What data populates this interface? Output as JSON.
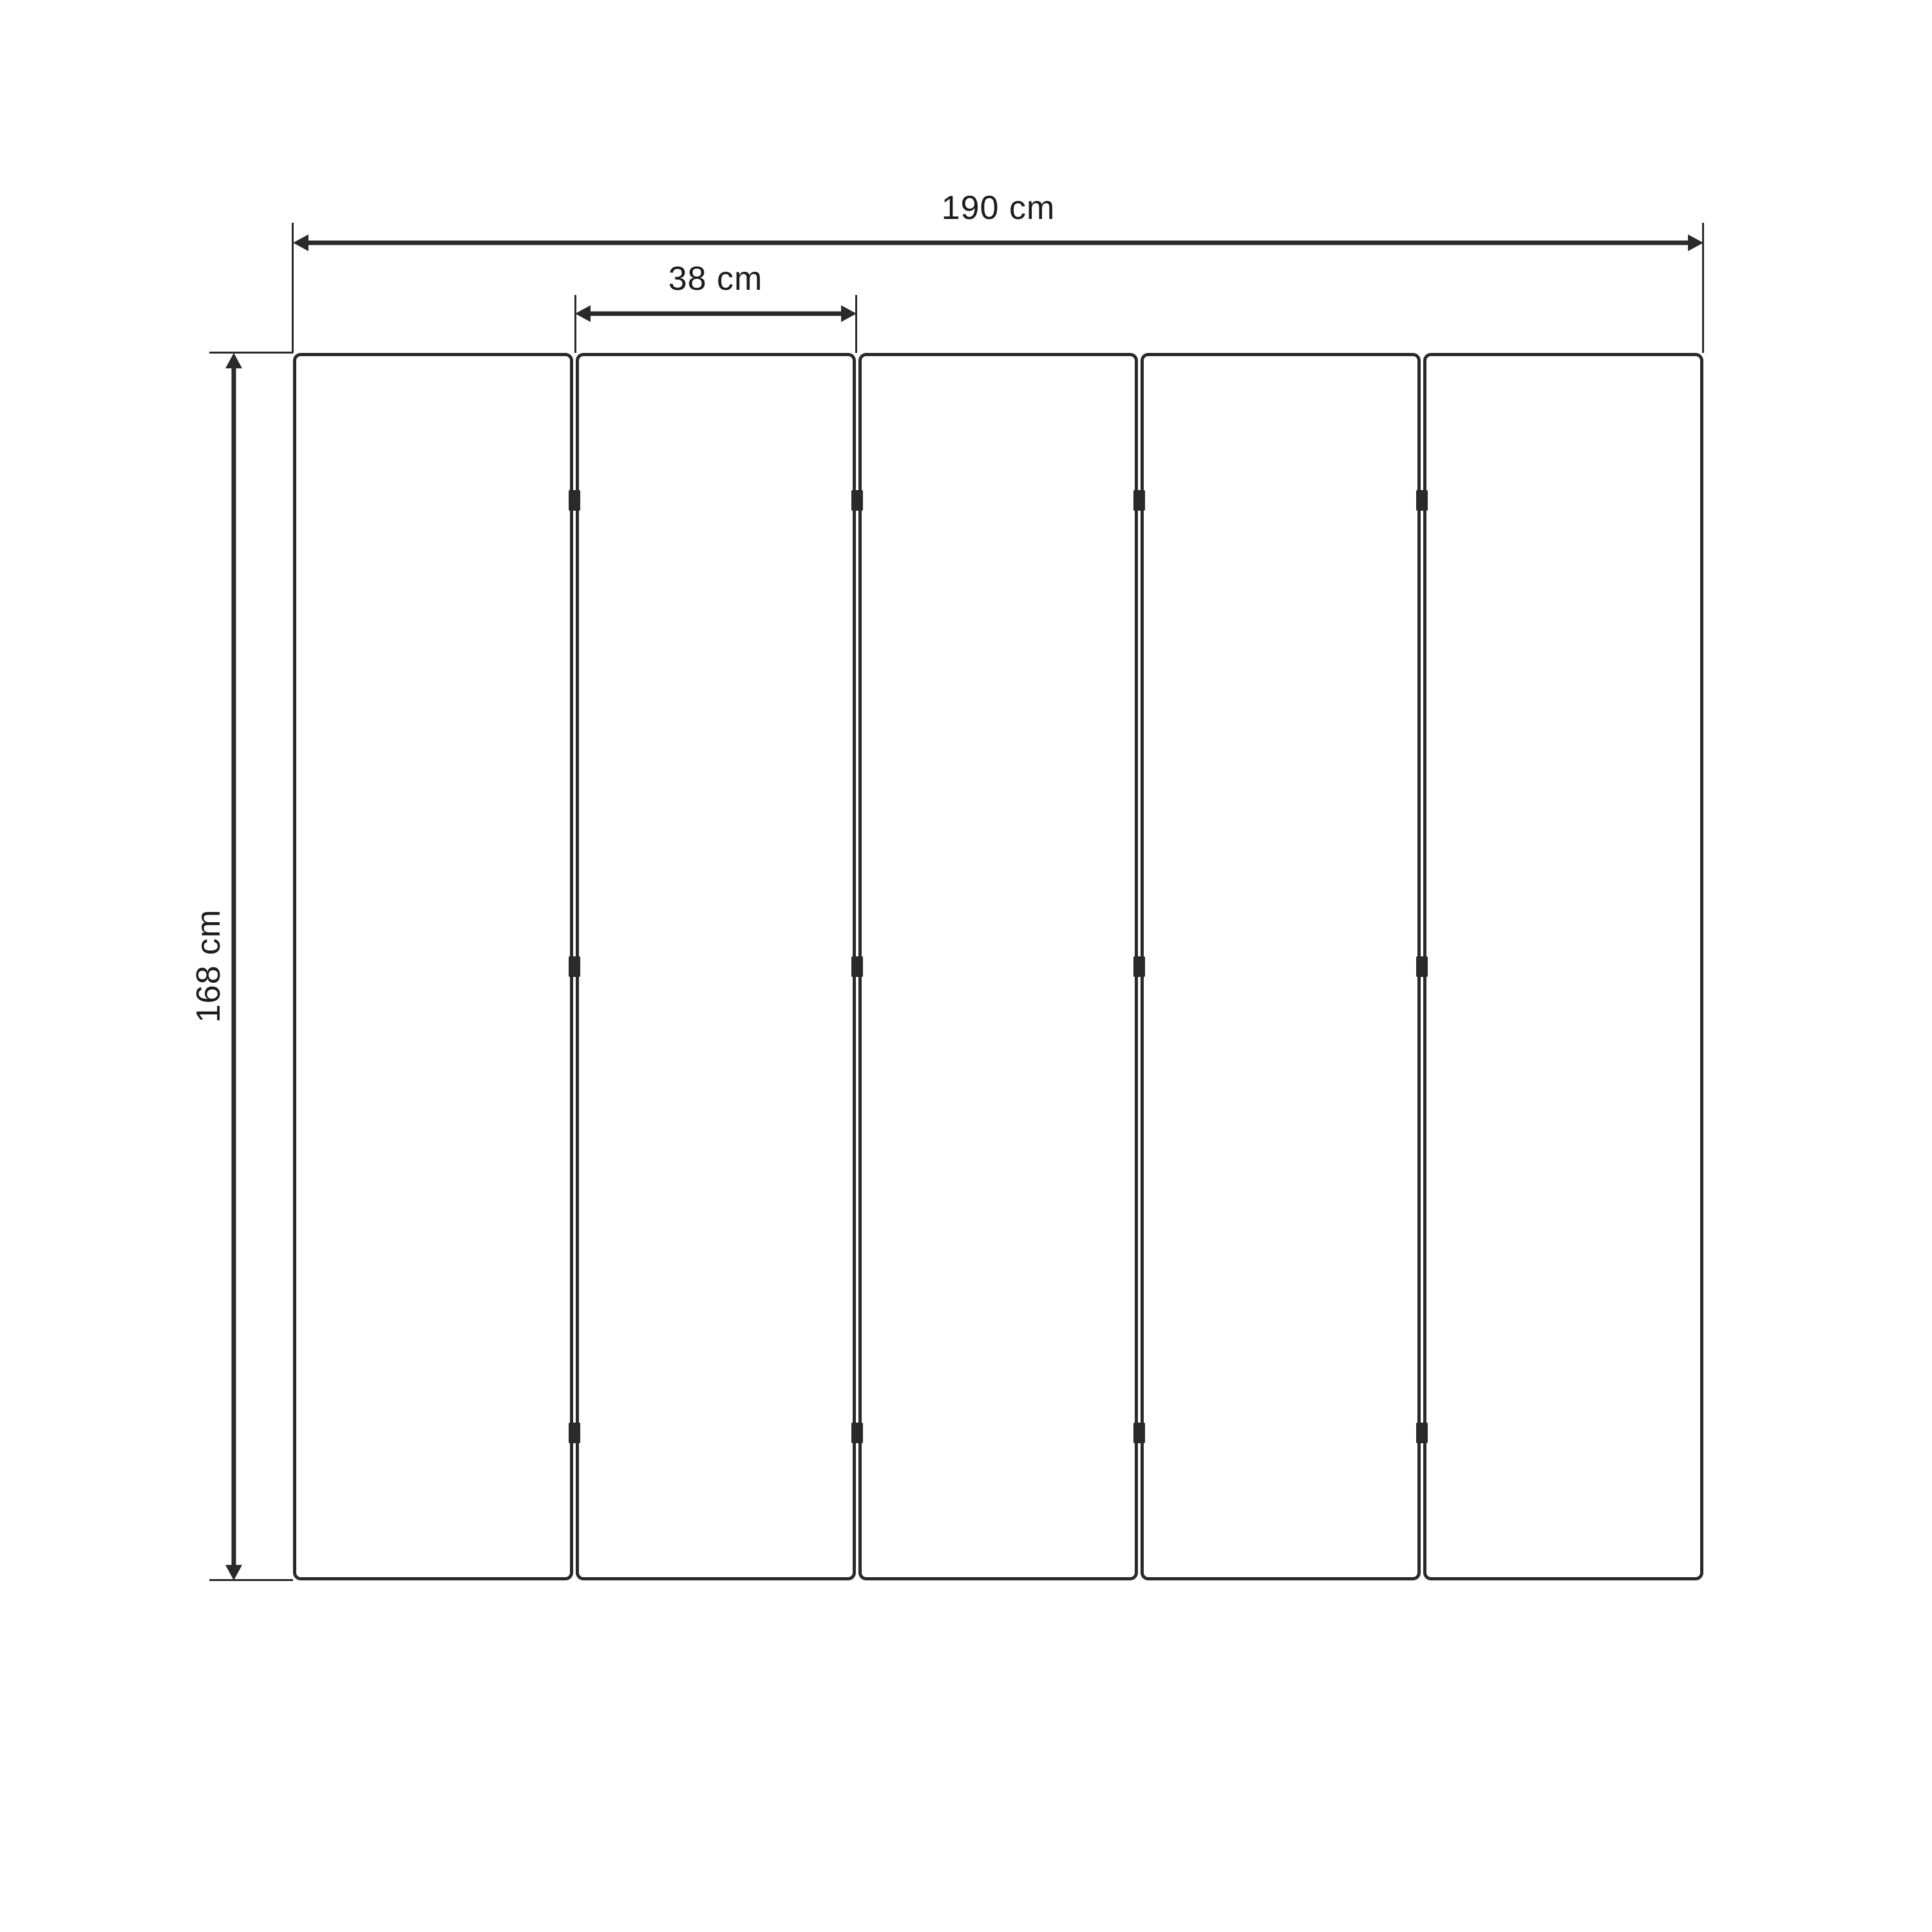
{
  "diagram": {
    "labels": {
      "total_width": "190 cm",
      "panel_width": "38 cm",
      "height": "168 cm"
    },
    "panel_count": 5,
    "hinges_per_gap": 3,
    "colors": {
      "line": "#2a2a2a",
      "text": "#1c1c1c",
      "background": "#ffffff"
    }
  }
}
